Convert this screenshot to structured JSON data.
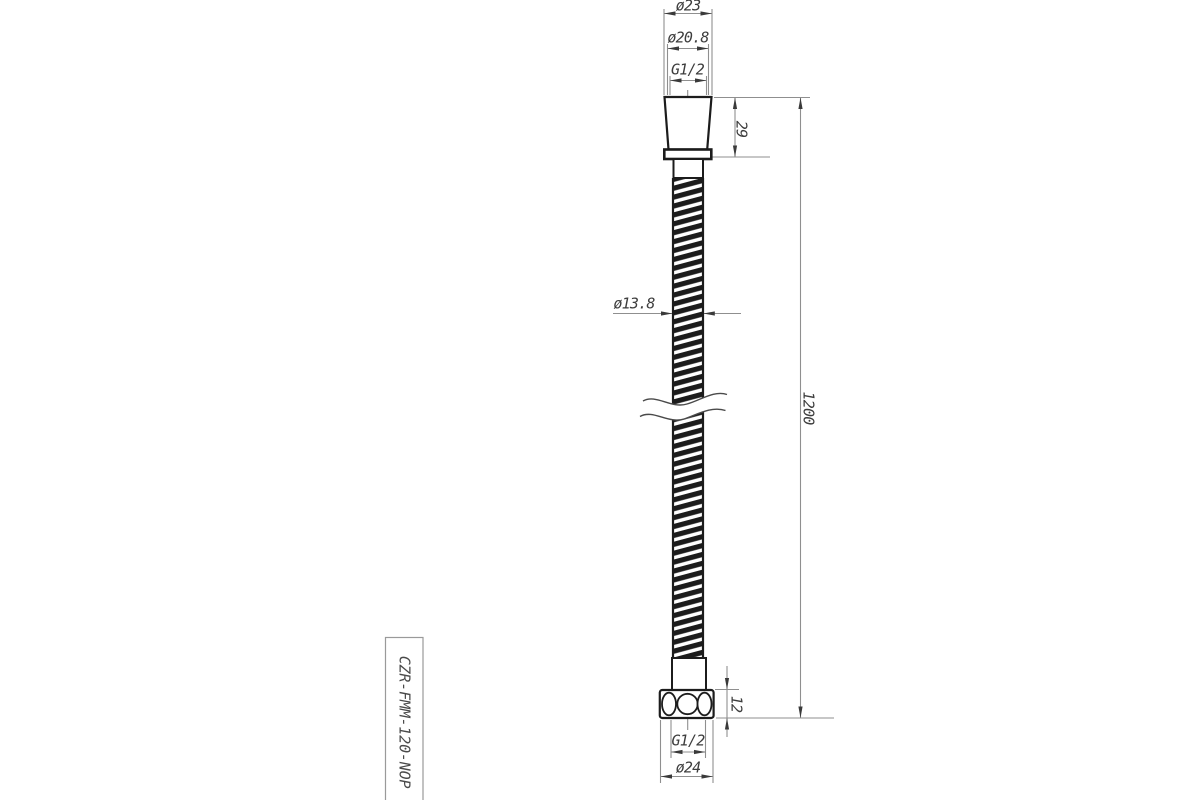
{
  "drawing": {
    "title": "shower-hose-technical-drawing",
    "part_number": "CZR-FMM-120-NOP",
    "dimensions": {
      "top_outer_diameter": "ø23",
      "top_inner_diameter": "ø20.8",
      "top_thread": "G1/2",
      "top_connector_height": "29",
      "hose_diameter": "ø13.8",
      "total_length": "1200",
      "bottom_nut_height": "12",
      "bottom_thread": "G1/2",
      "bottom_nut_diameter": "ø24"
    },
    "colors": {
      "background": "#ffffff",
      "object_line": "#1c1c1c",
      "dimension_line": "#8f8f8f",
      "arrow": "#3a3a3a",
      "text": "#3d3d3d"
    }
  }
}
